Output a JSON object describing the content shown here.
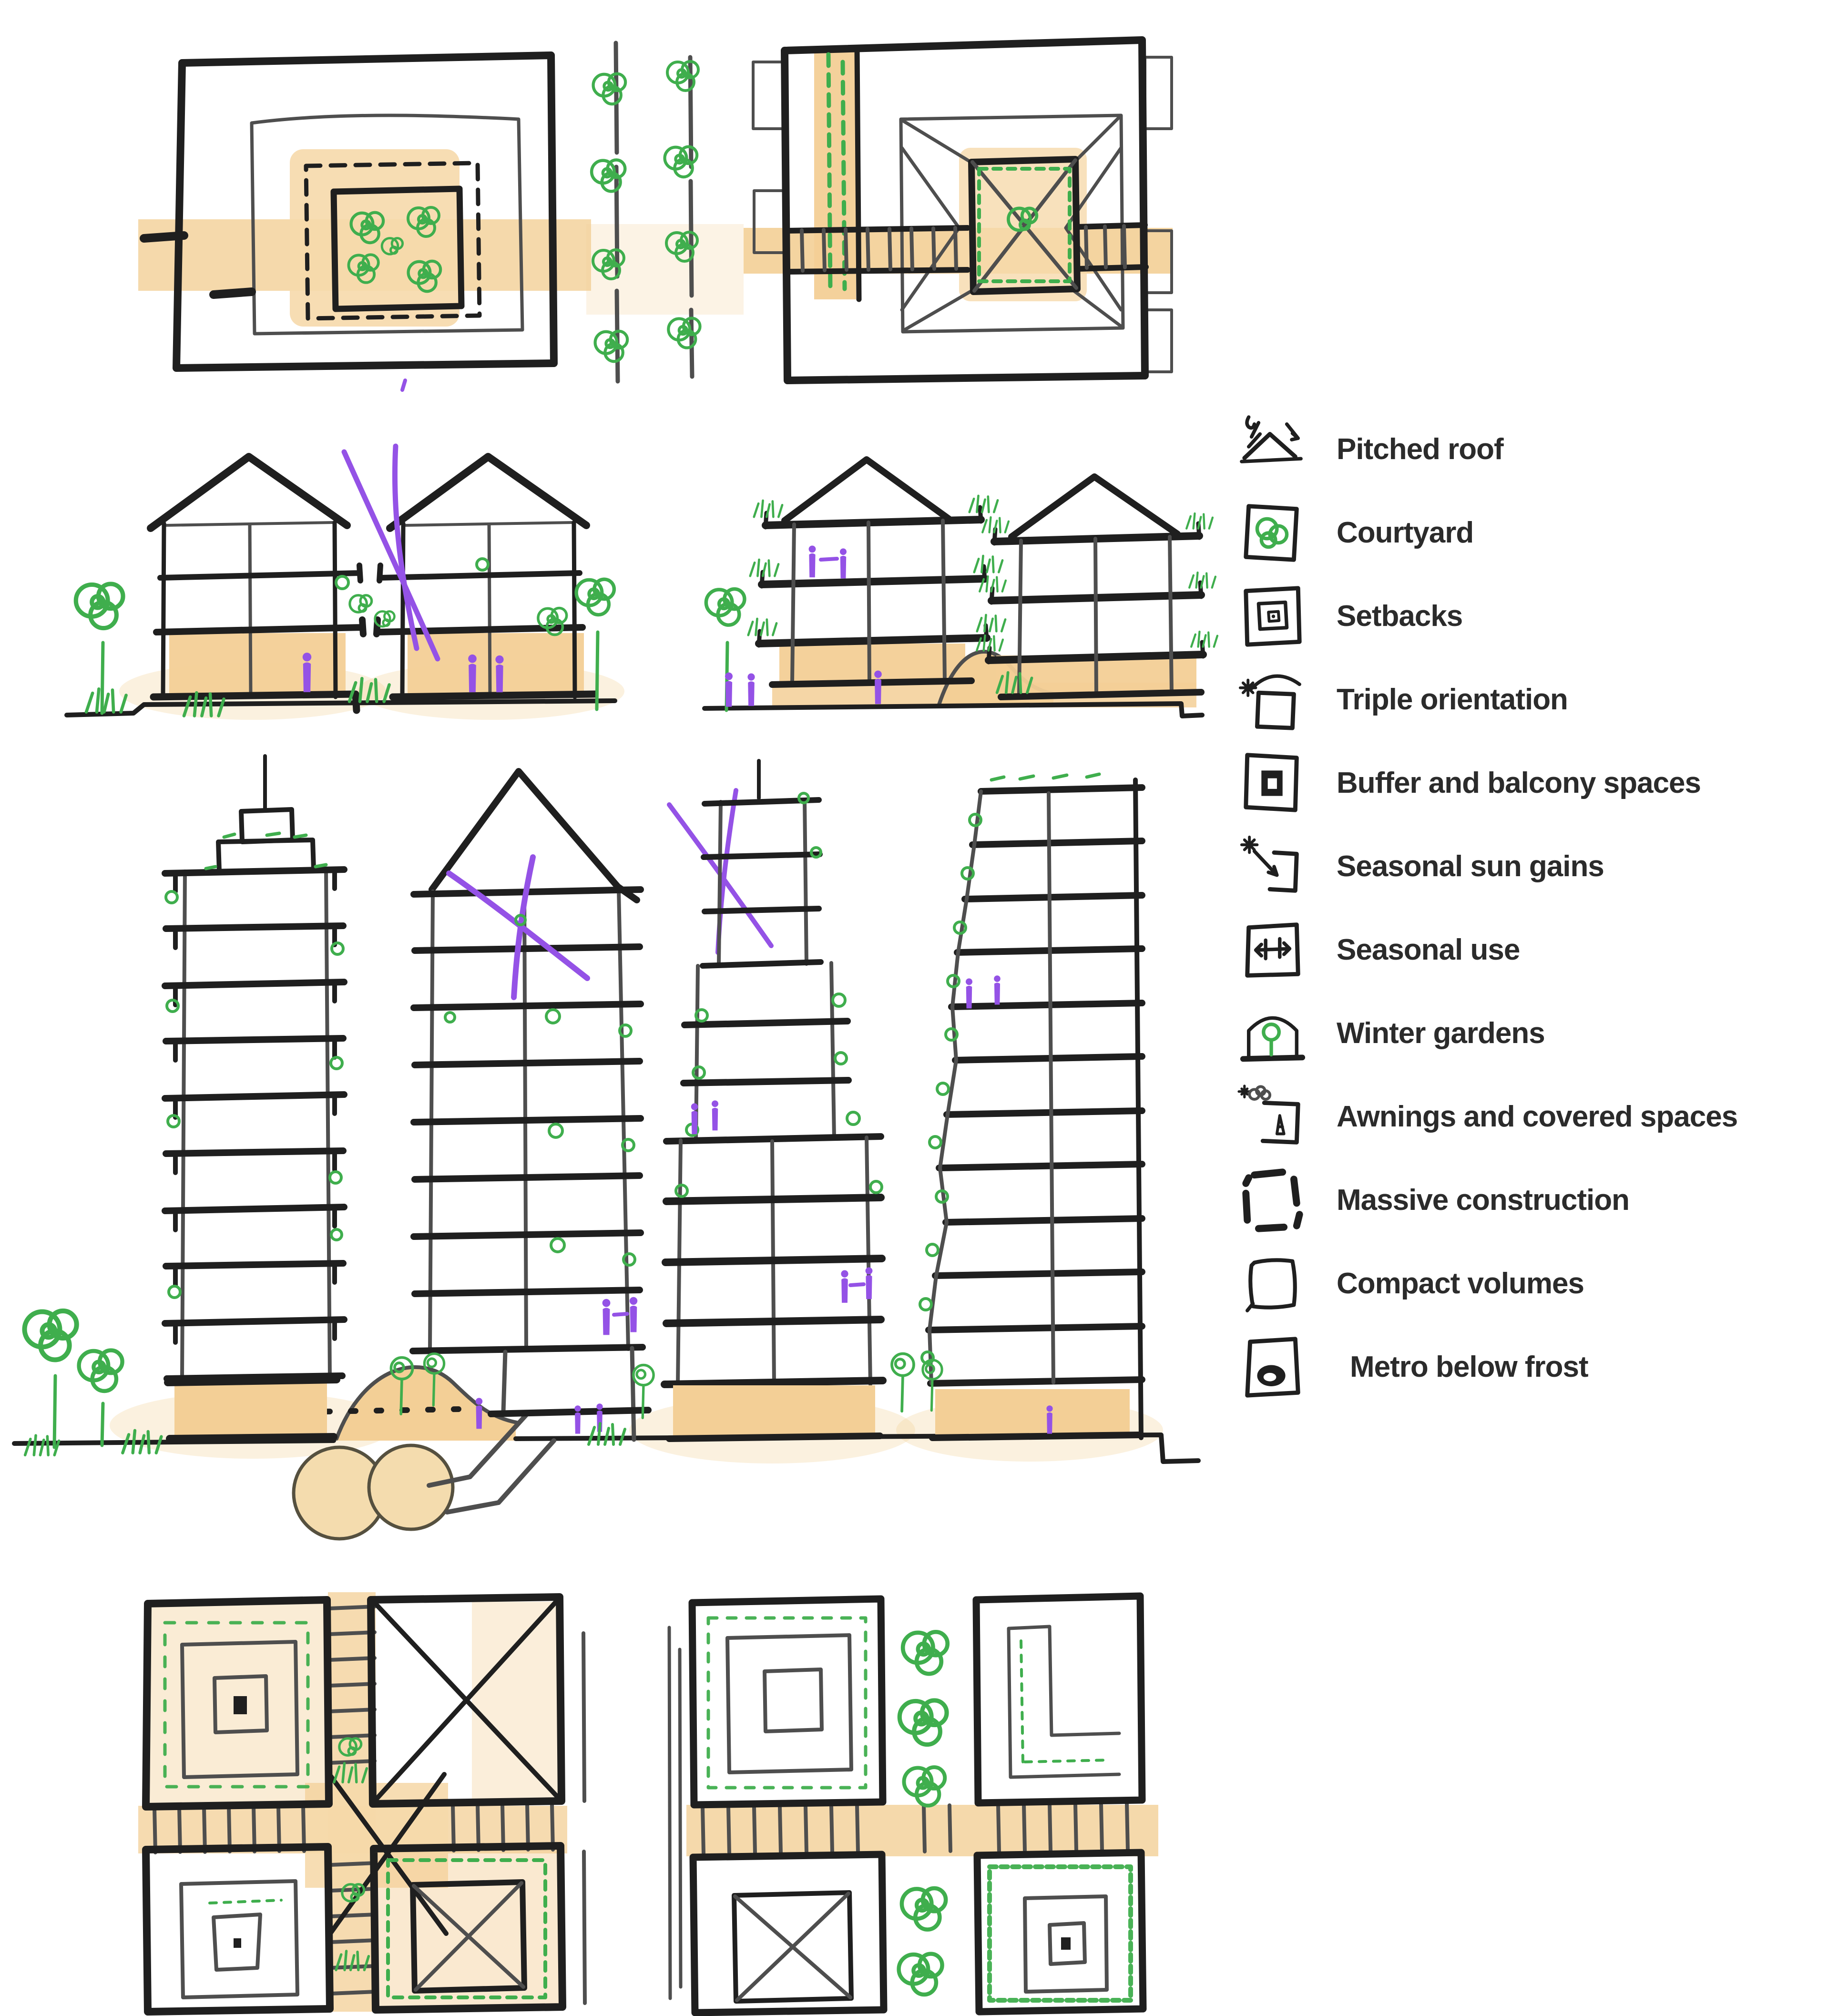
{
  "palette": {
    "ink": "#1f1f1f",
    "line_gray": "#4e4e4e",
    "orange": "#f3cf96",
    "green": "#3fae4d",
    "purple": "#9452e6",
    "paper": "#ffffff"
  },
  "legend": {
    "items": [
      {
        "icon": "pitched-roof-icon",
        "label": "Pitched roof"
      },
      {
        "icon": "courtyard-icon",
        "label": "Courtyard"
      },
      {
        "icon": "setbacks-icon",
        "label": "Setbacks"
      },
      {
        "icon": "triple-orientation-icon",
        "label": "Triple orientation"
      },
      {
        "icon": "buffer-balcony-icon",
        "label": "Buffer and balcony spaces"
      },
      {
        "icon": "seasonal-sun-gains-icon",
        "label": "Seasonal sun gains"
      },
      {
        "icon": "seasonal-use-icon",
        "label": "Seasonal use"
      },
      {
        "icon": "winter-gardens-icon",
        "label": "Winter gardens"
      },
      {
        "icon": "awnings-covered-spaces-icon",
        "label": "Awnings and covered spaces"
      },
      {
        "icon": "massive-construction-icon",
        "label": "Massive construction"
      },
      {
        "icon": "compact-volumes-icon",
        "label": "Compact volumes"
      },
      {
        "icon": "metro-below-frost-icon",
        "label": "Metro below frost"
      }
    ]
  }
}
